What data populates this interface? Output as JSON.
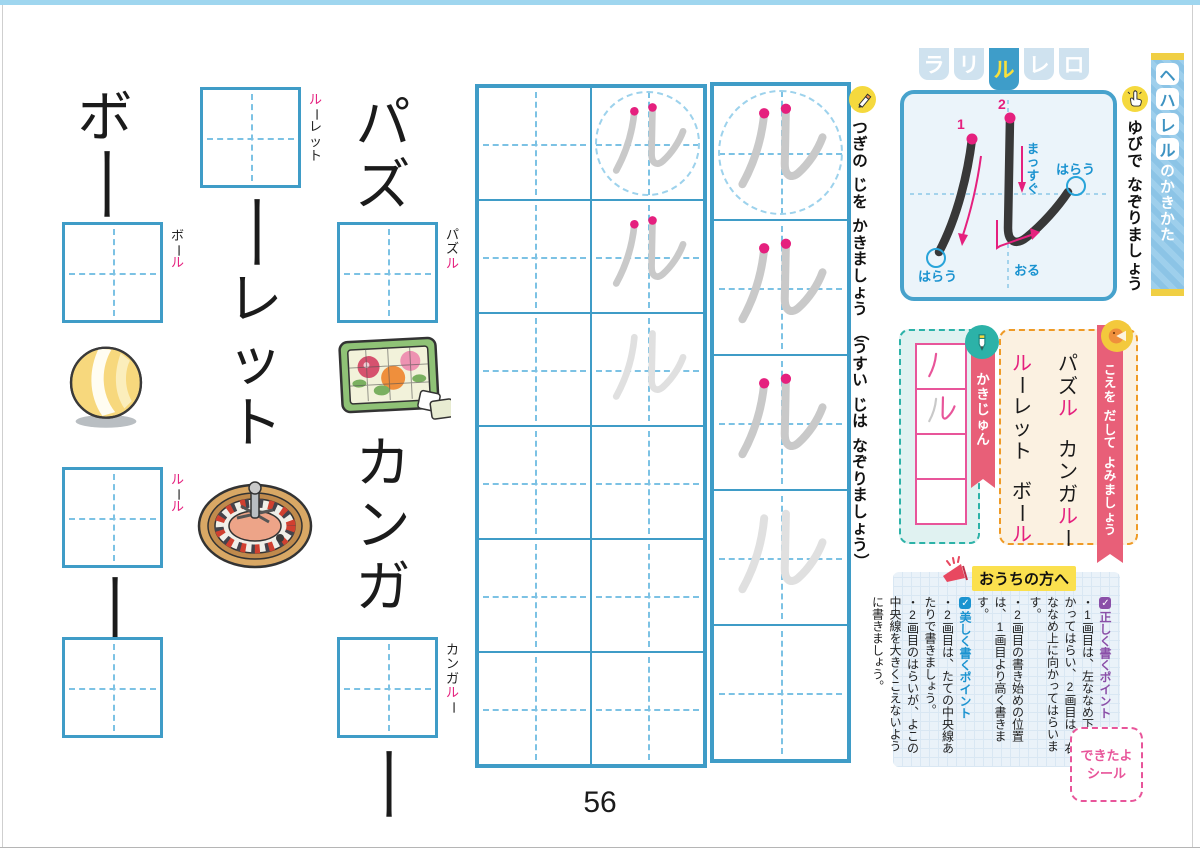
{
  "page": {
    "number": "56"
  },
  "colors": {
    "accent_pink": "#e5207e",
    "grid_blue": "#3f9cc7",
    "ribbon_red": "#e85f78",
    "teal": "#2cb2a8",
    "orange": "#ef9a25",
    "purple": "#8a4fa8",
    "point_blue": "#1b93d0",
    "icon_yellow": "#f5d93e"
  },
  "header": {
    "tabs": [
      "ラ",
      "リ",
      "ル",
      "レ",
      "ロ"
    ],
    "active_index": 2
  },
  "side_banner": {
    "letters": [
      "ヘ",
      "ハ",
      "レ",
      "ル"
    ],
    "suffix": "のかきかた"
  },
  "stroke_diagram": {
    "stroke1_num": "1",
    "stroke2_num": "2",
    "label_straight": "まっすぐ",
    "label_sweep1": "はらう",
    "label_sweep2": "はらう",
    "label_fold": "おる"
  },
  "instructions": {
    "finger": "ゆびで なぞりましょう",
    "write": "つぎの じを かきましょう （うすい じは なぞりましょう）"
  },
  "stroke_order": {
    "label": "かきじゅん",
    "cells": [
      {
        "strokes": [
          "first-pink"
        ]
      },
      {
        "strokes": [
          "first-gray",
          "second-pink"
        ]
      },
      {
        "strokes": []
      },
      {
        "strokes": []
      }
    ]
  },
  "reading": {
    "label": "こえを だして よみましょう",
    "columns": [
      {
        "words": [
          [
            {
              "c": "パ"
            },
            {
              "c": "ズ"
            },
            {
              "c": "ル",
              "pink": true
            }
          ],
          [
            {
              "c": "カ"
            },
            {
              "c": "ン"
            },
            {
              "c": "ガ"
            },
            {
              "c": "ル",
              "pink": true
            },
            {
              "c": "ー"
            }
          ]
        ]
      },
      {
        "words": [
          [
            {
              "c": "ル",
              "pink": true
            },
            {
              "c": "ー"
            },
            {
              "c": "レ"
            },
            {
              "c": "ッ"
            },
            {
              "c": "ト"
            }
          ],
          [
            {
              "c": "ボ"
            },
            {
              "c": "ー"
            },
            {
              "c": "ル",
              "pink": true
            }
          ]
        ]
      }
    ]
  },
  "word_exercises": {
    "ball": {
      "display": [
        {
          "c": "ボ"
        },
        {
          "c": "ー"
        }
      ],
      "label": [
        {
          "c": "ボ"
        },
        {
          "c": "ー"
        },
        {
          "c": "ル",
          "pink": true
        }
      ],
      "image": "beach-ball"
    },
    "roulette": {
      "display": [
        {
          "c": "ー"
        },
        {
          "c": "レ"
        },
        {
          "c": "ッ"
        },
        {
          "c": "ト"
        }
      ],
      "label": [
        {
          "c": "ル",
          "pink": true
        },
        {
          "c": "ー"
        },
        {
          "c": "レ"
        },
        {
          "c": "ッ"
        },
        {
          "c": "ト"
        }
      ],
      "image": "roulette-wheel"
    },
    "rule": {
      "display": [
        {
          "c": "ー"
        }
      ],
      "label": [
        {
          "c": "ル",
          "pink": true
        },
        {
          "c": "ー"
        },
        {
          "c": "ル",
          "pink": true
        }
      ]
    },
    "puzzle": {
      "display": [
        {
          "c": "パ"
        },
        {
          "c": "ズ"
        }
      ],
      "label": [
        {
          "c": "パ"
        },
        {
          "c": "ズ"
        },
        {
          "c": "ル",
          "pink": true
        }
      ],
      "image": "flower-puzzle"
    },
    "kangaroo": {
      "display": [
        {
          "c": "カ"
        },
        {
          "c": "ン"
        },
        {
          "c": "ガ"
        }
      ],
      "display_after": [
        {
          "c": "ー"
        }
      ],
      "label": [
        {
          "c": "カ"
        },
        {
          "c": "ン"
        },
        {
          "c": "ガ"
        },
        {
          "c": "ル",
          "pink": true
        },
        {
          "c": "ー"
        }
      ]
    }
  },
  "practice_grids": [
    {
      "name": "grid-two-col",
      "cols": 2,
      "rows": 6,
      "cells": [
        {
          "r": 0,
          "c": 1,
          "circle": true,
          "trace": "gray",
          "dots": true
        },
        {
          "r": 1,
          "c": 1,
          "trace": "gray",
          "dots": true
        },
        {
          "r": 2,
          "c": 1,
          "trace": "light"
        }
      ]
    },
    {
      "name": "grid-one-col",
      "cols": 1,
      "rows": 5,
      "cells": [
        {
          "r": 0,
          "c": 0,
          "circle": true,
          "trace": "gray",
          "dots": true
        },
        {
          "r": 1,
          "c": 0,
          "trace": "gray",
          "dots": true
        },
        {
          "r": 2,
          "c": 0,
          "trace": "gray",
          "dots": true
        },
        {
          "r": 3,
          "c": 0,
          "trace": "light"
        }
      ]
    }
  ],
  "parents_note": {
    "title": "おうちの方へ",
    "points": [
      {
        "type": "head",
        "color": "purple",
        "text": "正しく書くポイント"
      },
      {
        "type": "item",
        "text": "・1画目は、左ななめ下に向かってはらい、2画目は、右ななめ上に向かってはらいます。"
      },
      {
        "type": "item",
        "text": "・2画目の書き始めの位置は、1画目より高く書きます。"
      },
      {
        "type": "head",
        "color": "blue",
        "text": "美しく書くポイント"
      },
      {
        "type": "item",
        "text": "・2画目は、たての中央線あたりで書きましょう。"
      },
      {
        "type": "item",
        "text": "・2画目のはらいが、よこの中央線を大きくこえないように書きましょう。"
      }
    ]
  },
  "sticker": {
    "line1": "できたよ",
    "line2": "シール"
  }
}
